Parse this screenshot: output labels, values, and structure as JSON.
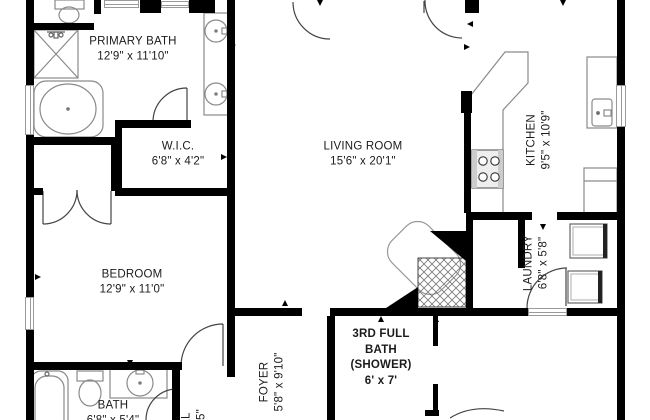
{
  "app": {
    "type": "floor-plan-view"
  },
  "colors": {
    "wall": "#000000",
    "fixture": "#8a8a8a",
    "door": "#444444",
    "text": "#1b1b1b",
    "background": "#ffffff"
  },
  "rooms": {
    "primary_bath": {
      "name": "PRIMARY BATH",
      "dims": "12'9\" x 11'10\""
    },
    "wic": {
      "name": "W.I.C.",
      "dims": "6'8\" x 4'2\""
    },
    "bedroom": {
      "name": "BEDROOM",
      "dims": "12'9\" x 11'0\""
    },
    "living_room": {
      "name": "LIVING ROOM",
      "dims": "15'6\" x 20'1\""
    },
    "kitchen": {
      "name": "KITCHEN",
      "dims": "9'5\" x 10'9\""
    },
    "laundry": {
      "name": "LAUNDRY",
      "dims": "6'8\" x 5'8\""
    },
    "foyer": {
      "name": "FOYER",
      "dims": "5'8\" x 9'10\""
    },
    "third_bath": {
      "line1": "3RD FULL",
      "line2": "BATH",
      "line3": "(SHOWER)",
      "dims": "6' x 7'"
    },
    "bath": {
      "name": "BATH",
      "dims": "6'8\" x 5'4\""
    },
    "hall": {
      "name": "LL",
      "dims": "7'5\""
    }
  }
}
